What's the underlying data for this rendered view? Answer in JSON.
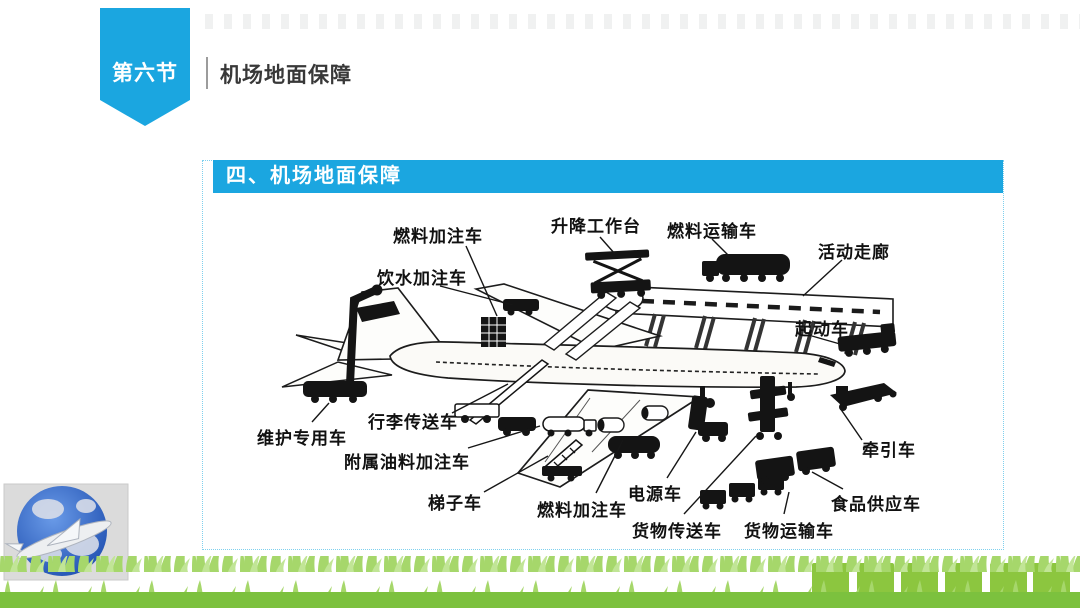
{
  "slide": {
    "section_badge": "第六节",
    "header_title": "机场地面保障",
    "panel_title": "四、机场地面保障"
  },
  "diagram": {
    "labels": [
      "燃料加注车",
      "升降工作台",
      "燃料运输车",
      "活动走廊",
      "饮水加注车",
      "起动车",
      "维护专用车",
      "行李传送车",
      "附属油料加注车",
      "梯子车",
      "燃料加注车",
      "电源车",
      "货物传送车",
      "货物运输车",
      "食品供应车",
      "牵引车"
    ]
  },
  "footer": {
    "green_squares_count": 6
  },
  "colors": {
    "accent_cyan": "#1BA6E0",
    "panel_border": "#7FD0EE",
    "grass_light": "#A6D76B",
    "grass_base": "#7CC13E",
    "square_green": "#8CC63F",
    "globe_blue": "#2E62C8"
  }
}
